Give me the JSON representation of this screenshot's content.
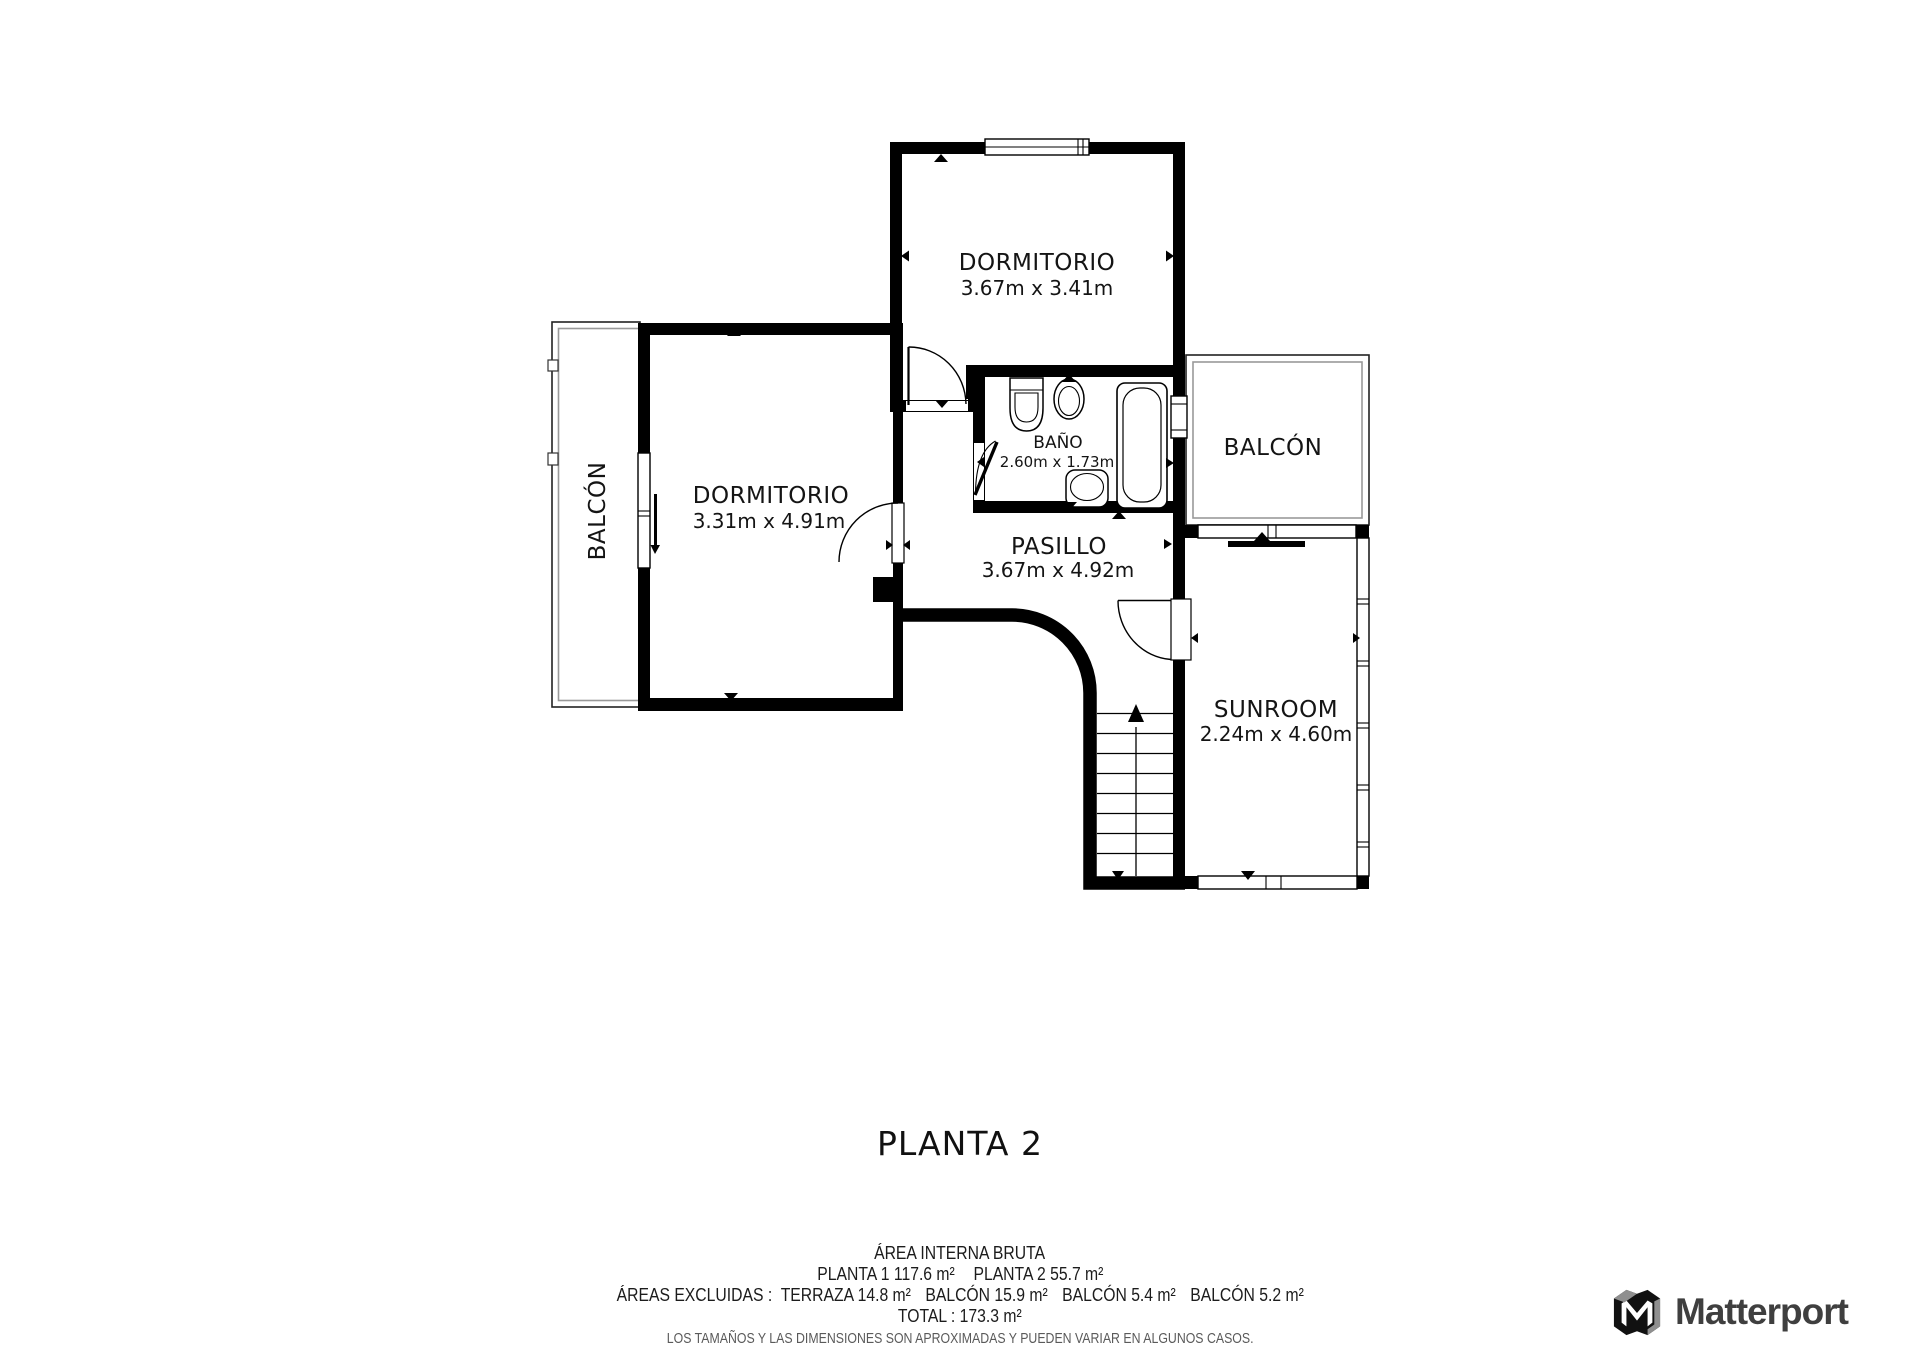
{
  "plan": {
    "title": "PLANTA 2",
    "rooms": {
      "dormitorio_top": {
        "name": "DORMITORIO",
        "dims": "3.67m x 3.41m"
      },
      "dormitorio_left": {
        "name": "DORMITORIO",
        "dims": "3.31m x 4.91m"
      },
      "bano": {
        "name": "BAÑO",
        "dims": "2.60m x 1.73m"
      },
      "pasillo": {
        "name": "PASILLO",
        "dims": "3.67m x 4.92m"
      },
      "sunroom": {
        "name": "SUNROOM",
        "dims": "2.24m x 4.60m"
      },
      "balcon_left": {
        "name": "BALCÓN"
      },
      "balcon_right": {
        "name": "BALCÓN"
      }
    }
  },
  "footer": {
    "area_title": "ÁREA INTERNA BRUTA",
    "planta1": "PLANTA 1 117.6 m²",
    "planta2": "PLANTA 2 55.7 m²",
    "excluded_label": "ÁREAS EXCLUIDAS :",
    "excluded_items": [
      "TERRAZA 14.8 m²",
      "BALCÓN 15.9 m²",
      "BALCÓN 5.4 m²",
      "BALCÓN 5.2 m²"
    ],
    "total": "TOTAL :  173.3 m²",
    "disclaimer": "LOS TAMAÑOS Y LAS DIMENSIONES SON APROXIMADAS Y PUEDEN VARIAR EN ALGUNOS CASOS."
  },
  "brand": {
    "wordmark": "Matterport"
  },
  "colors": {
    "wall": "#000000",
    "text": "#141414",
    "disclaimer_text": "#5a5a5a",
    "brand_text": "#3f3f3f",
    "brand_gray": "#8f8f8f",
    "balcony_inner_line": "#999999"
  }
}
